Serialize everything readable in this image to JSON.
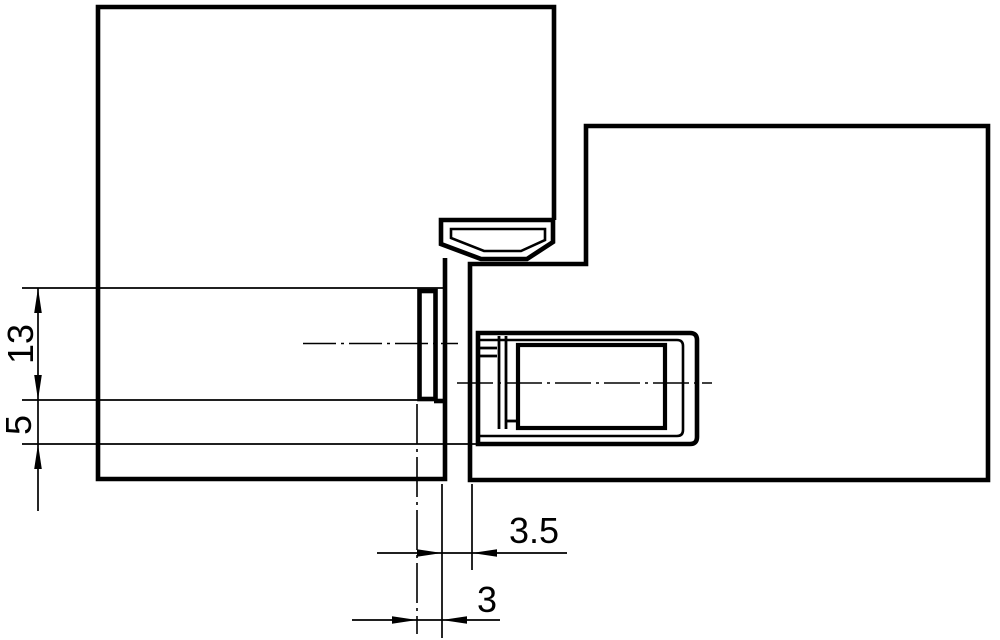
{
  "drawing": {
    "kind": "technical-section-drawing",
    "colors": {
      "line": "#000000",
      "background": "#ffffff"
    },
    "dimensions": {
      "mortise_depth": {
        "label": "13"
      },
      "bottom_offset": {
        "label": "5"
      },
      "rebate_gap": {
        "label": "3.5"
      },
      "edge_inset": {
        "label": "3"
      }
    }
  }
}
